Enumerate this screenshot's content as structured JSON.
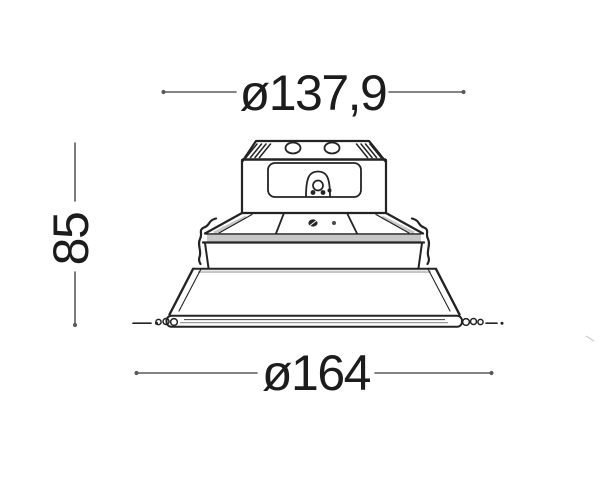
{
  "drawing": {
    "subject": "recessed-downlight-side-view-dimension-drawing",
    "dimensions": {
      "top_diameter": "ø137,9",
      "height": "85",
      "bottom_diameter": "ø164"
    },
    "colors": {
      "outline": "#232323",
      "dimension_line": "#5a5a5a",
      "text": "#1c1c1c",
      "shading": "#c7c7c7",
      "background": "#ffffff"
    }
  }
}
